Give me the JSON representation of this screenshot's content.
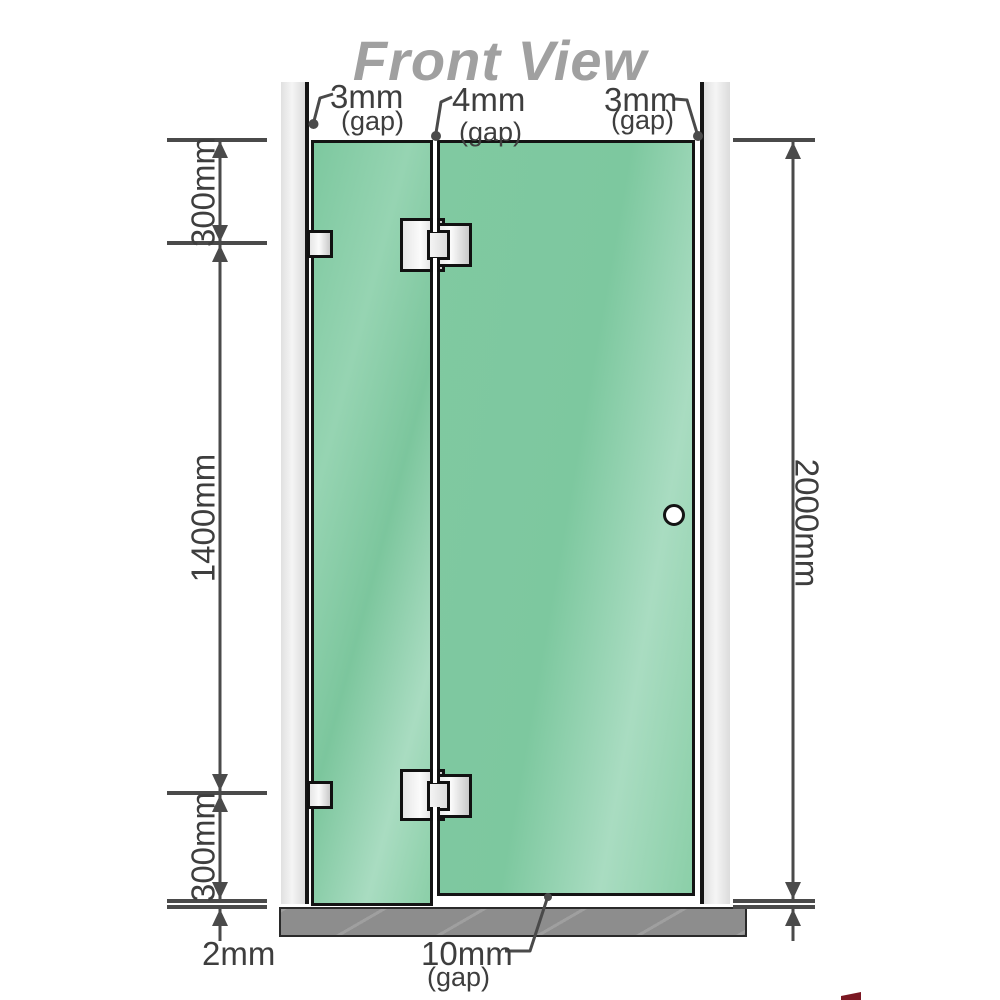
{
  "title": "Front View",
  "annotations": {
    "top_gaps": [
      {
        "value": "3mm",
        "note": "(gap)"
      },
      {
        "value": "4mm",
        "note": "(gap)"
      },
      {
        "value": "3mm",
        "note": "(gap)"
      }
    ],
    "left_dims": {
      "top": "300mm",
      "middle": "1400mm",
      "bottom": "300mm",
      "floor": "2mm"
    },
    "right_dim": {
      "total_height": "2000mm"
    },
    "bottom_gap": {
      "value": "10mm",
      "note": "(gap)"
    }
  },
  "colors": {
    "glass_green": "#7dc89f",
    "glass_highlight": "#a9dcc1",
    "wall_gray": "#e9e9e9",
    "floor_gray": "#8d8d8d",
    "line_gray": "#4a4a4a",
    "title_gray": "#a0a0a0",
    "logo_red": "#7b1722"
  }
}
